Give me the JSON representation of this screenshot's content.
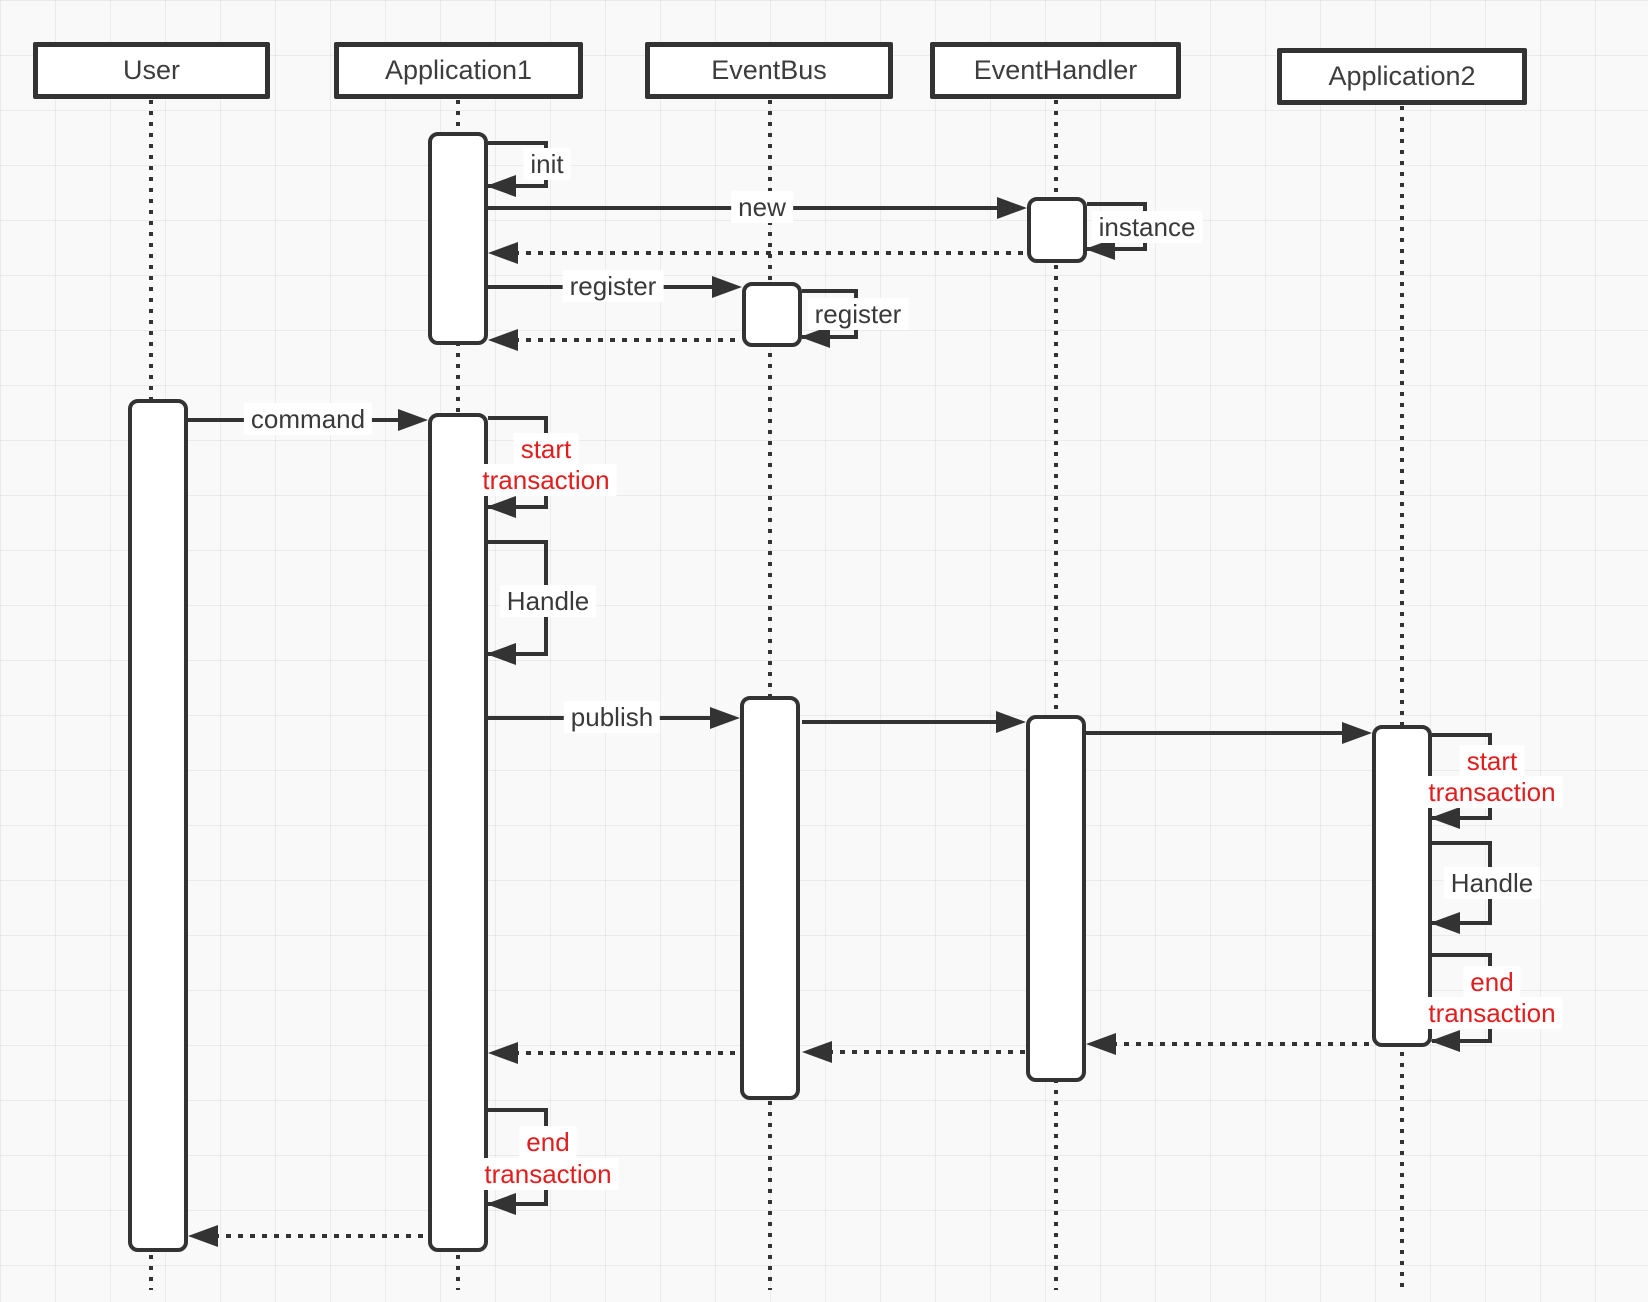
{
  "diagram_type": "uml-sequence-diagram",
  "participants": [
    {
      "name": "User"
    },
    {
      "name": "Application1"
    },
    {
      "name": "EventBus"
    },
    {
      "name": "EventHandler"
    },
    {
      "name": "Application2"
    }
  ],
  "messages": {
    "init": "init",
    "new": "new",
    "instance": "instance",
    "register": "register",
    "register_self": "register",
    "command": "command",
    "publish": "publish",
    "app1_start_tx": {
      "line1": "start",
      "line2": "transaction"
    },
    "app1_handle": "Handle",
    "app1_end_tx": {
      "line1": "end",
      "line2": "transaction"
    },
    "app2_start_tx": {
      "line1": "start",
      "line2": "transaction"
    },
    "app2_handle": "Handle",
    "app2_end_tx": {
      "line1": "end",
      "line2": "transaction"
    }
  },
  "colors": {
    "stroke": "#333333",
    "text": "#3a3a3a",
    "transaction_red": "#e11d1d",
    "fill": "#ffffff",
    "background": "#f9f9f9"
  }
}
